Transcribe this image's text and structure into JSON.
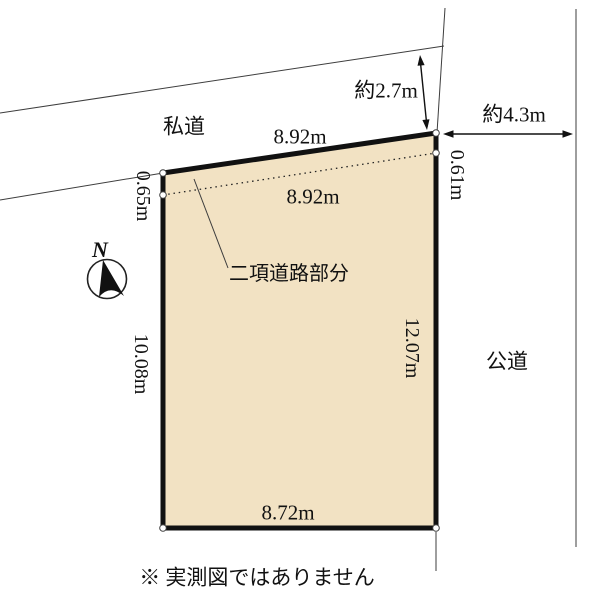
{
  "colors": {
    "background": "#ffffff",
    "plot_fill": "#F2E2C3",
    "plot_border": "#111111",
    "thin_line": "#3d3d3d",
    "text": "#111111"
  },
  "compass": {
    "north_label": "N"
  },
  "roads": {
    "private_road_label": "私道",
    "public_road_label": "公道"
  },
  "dimensions": {
    "top_edge": "8.92m",
    "setback_line": "8.92m",
    "bottom_edge": "8.72m",
    "left_edge": "10.08m",
    "right_edge": "12.07m",
    "left_setback": "0.65m",
    "right_setback": "0.61m",
    "private_road_width": "約2.7m",
    "public_road_width": "約4.3m"
  },
  "labels": {
    "setback_area": "二項道路部分"
  },
  "footnote": "※ 実測図ではありません"
}
